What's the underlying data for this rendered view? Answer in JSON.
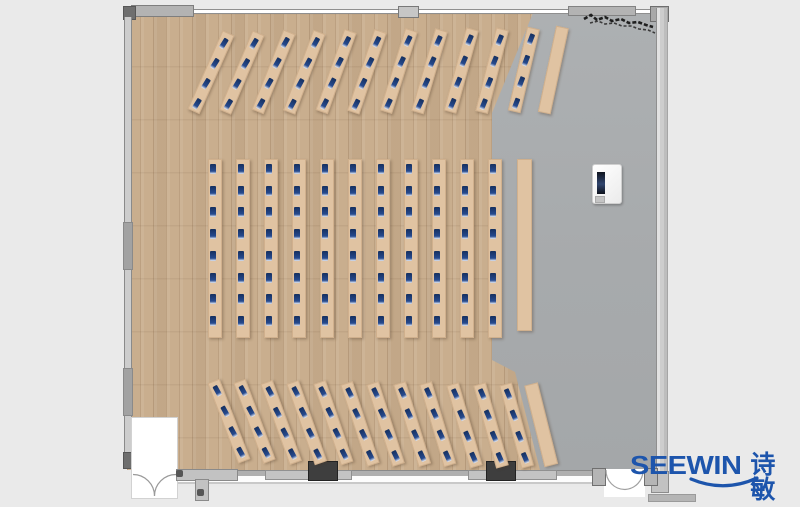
{
  "branding": {
    "brand": "SEEWIN",
    "brand_cjk": "诗敏",
    "color": "#1d55ac"
  },
  "palette": {
    "background": "#eaeaea",
    "wood_floor": "#c9ae8e",
    "concrete_floor": "#a8abad",
    "desk": "#e0c3a2",
    "monitor": "#264a8f",
    "wall": "#b3b3b3",
    "door_block": "#3e3e3e"
  },
  "furniture": {
    "sections": [
      {
        "id": "top-angled-row",
        "desk_count": 11,
        "monitors_per_desk": 4,
        "plain_desk_count": 1,
        "arrangement": "fanned rows angled right"
      },
      {
        "id": "center-columns",
        "desk_count": 11,
        "monitors_per_desk": 8,
        "plain_desk_count": 1,
        "arrangement": "straight vertical columns"
      },
      {
        "id": "bottom-angled-row",
        "desk_count": 12,
        "monitors_per_desk": 4,
        "plain_desk_count": 1,
        "arrangement": "fanned rows angled left"
      }
    ]
  },
  "objects": [
    {
      "id": "vending-machine"
    },
    {
      "id": "plant-sketch"
    },
    {
      "id": "double-door-bottom-left"
    },
    {
      "id": "double-door-bottom-right"
    }
  ]
}
